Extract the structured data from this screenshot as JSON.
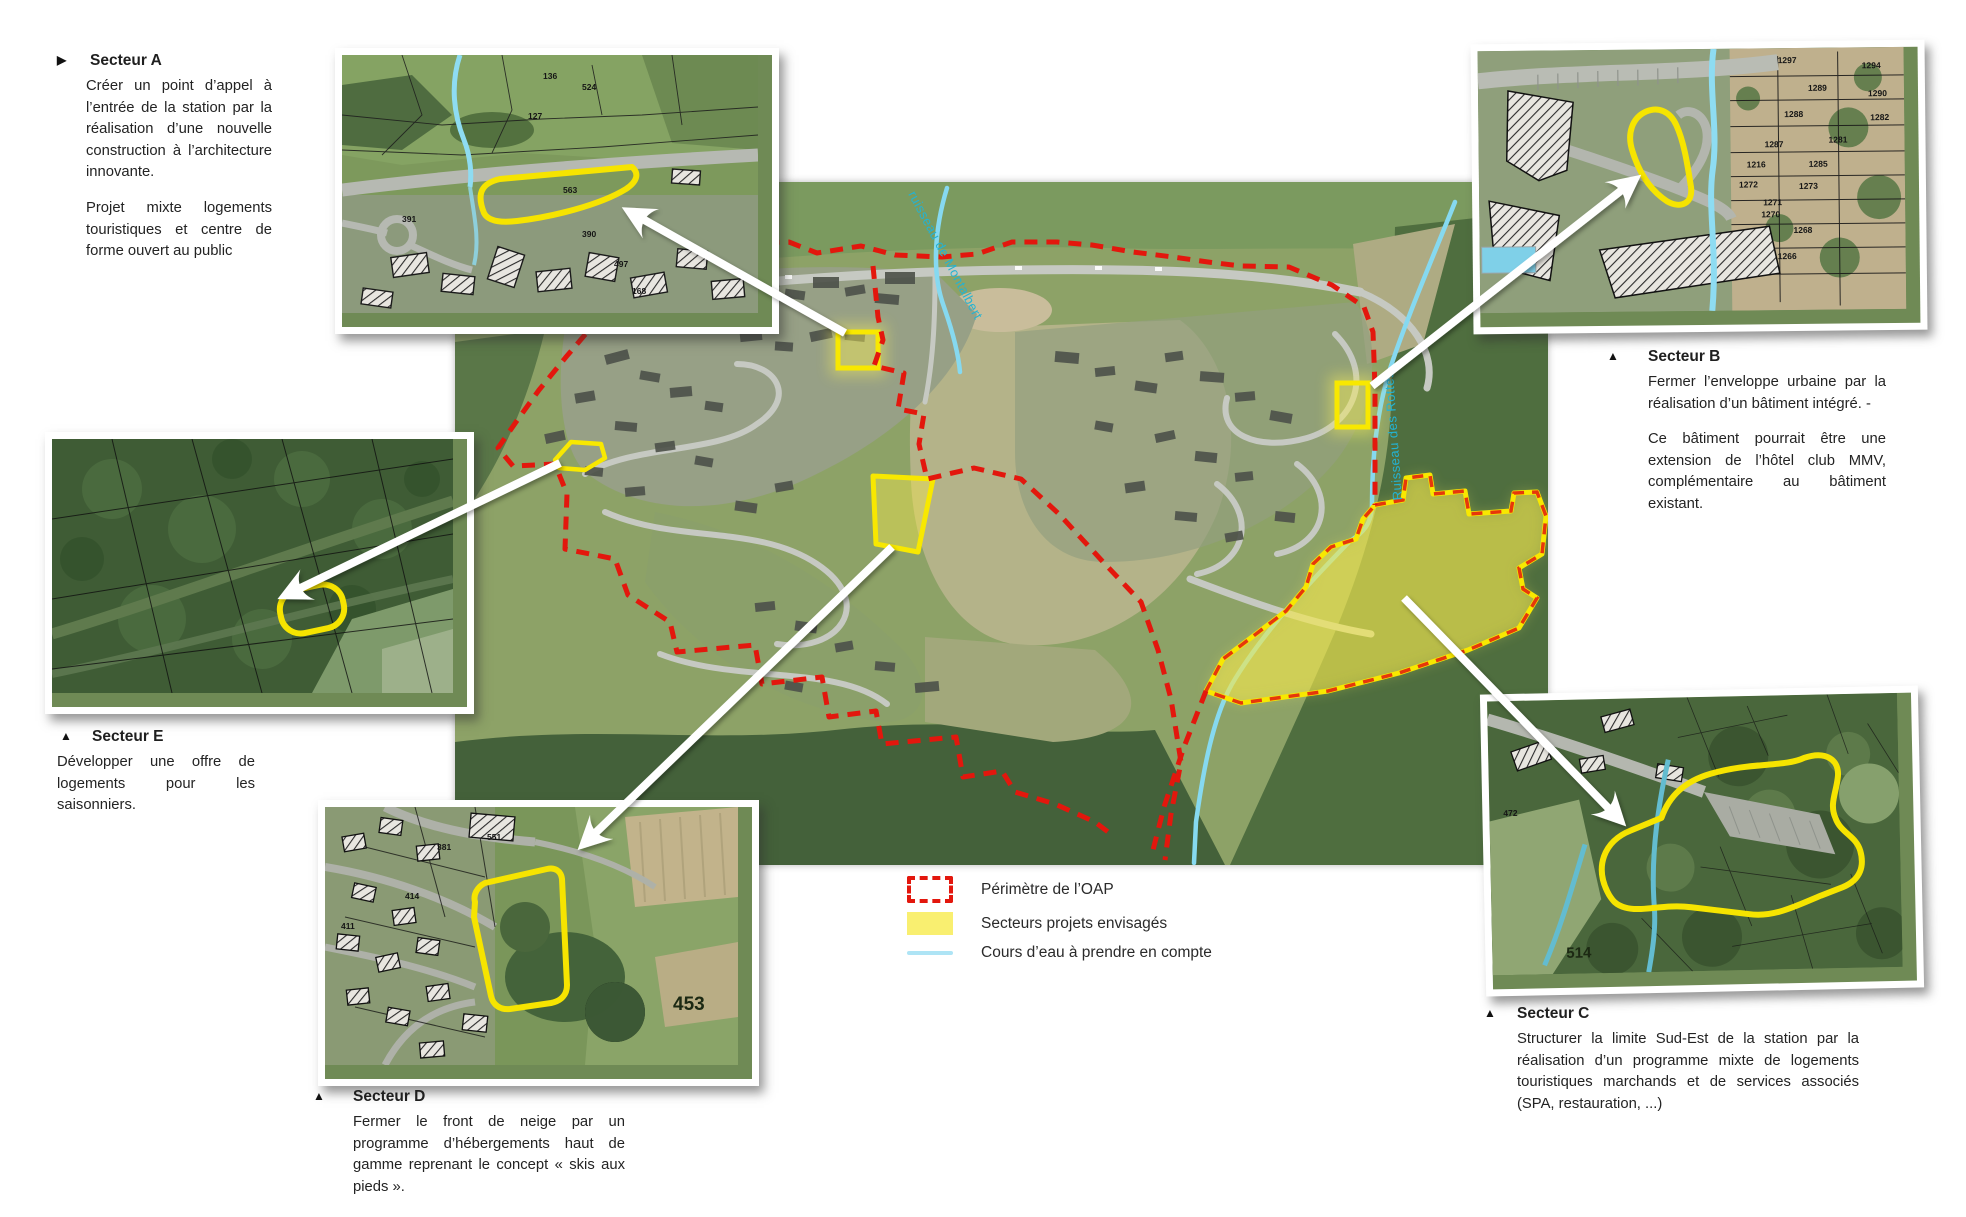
{
  "colors": {
    "perimeter_red": "#e3170d",
    "site_yellow": "#f8e800",
    "zone_fill_yellow": "#f2e64b",
    "stream_blue": "#86d9f0",
    "stream_label_cyan": "#23b3d3",
    "legend_blue": "#aee4f5",
    "legend_yellow": "#f9ef70"
  },
  "sectors": [
    {
      "id": "A",
      "marker": "▶",
      "title": "Secteur A",
      "paragraphs": [
        "Créer un point d’appel à l’entrée de la station par la réalisation d’une nouvelle construction à l’architecture innovante.",
        "Projet mixte logements touristiques et centre de forme ouvert au public"
      ]
    },
    {
      "id": "B",
      "marker": "▲",
      "title": "Secteur B",
      "paragraphs": [
        "Fermer l’enveloppe urbaine par la réalisation d’un bâtiment intégré. -",
        "Ce bâtiment pourrait être une extension de l’hôtel club MMV, complémentaire au bâtiment existant."
      ]
    },
    {
      "id": "C",
      "marker": "▲",
      "title": "Secteur C",
      "paragraphs": [
        "Structurer la limite Sud-Est de la station par la réalisation d’un programme mixte de logements touristiques marchands et de services associés (SPA, restauration, ...)"
      ]
    },
    {
      "id": "D",
      "marker": "▲",
      "title": "Secteur D",
      "paragraphs": [
        "Fermer le front de neige par un programme d’hébergements haut de gamme reprenant le concept « skis aux pieds »."
      ]
    },
    {
      "id": "E",
      "marker": "▲",
      "title": "Secteur E",
      "paragraphs": [
        "Développer une offre de logements pour les saisonniers."
      ]
    }
  ],
  "legend": {
    "perimetre": "Périmètre de l’OAP",
    "secteurs": "Secteurs projets envisagés",
    "cours_eau": "Cours d’eau à prendre en compte"
  },
  "map_labels": {
    "stream_montalbert": "ruisseau de Montalbert",
    "stream_rottes": "Ruisseau des Rottes"
  },
  "insets": {
    "top_left": {
      "parcels": [
        "136",
        "524",
        "127",
        "563",
        "391",
        "390",
        "497",
        "168"
      ]
    },
    "top_right": {
      "parcels": [
        "1297",
        "1294",
        "1289",
        "1290",
        "1288",
        "1282",
        "1287",
        "1281",
        "1216",
        "1285",
        "1272",
        "1273",
        "1271",
        "1270",
        "1268",
        "1266"
      ]
    },
    "bottom_center": {
      "parcels": [
        "381",
        "551",
        "414",
        "411"
      ],
      "big_parcel": "453"
    },
    "bottom_right": {
      "parcels": [
        "472"
      ],
      "big_parcel": "514"
    }
  }
}
